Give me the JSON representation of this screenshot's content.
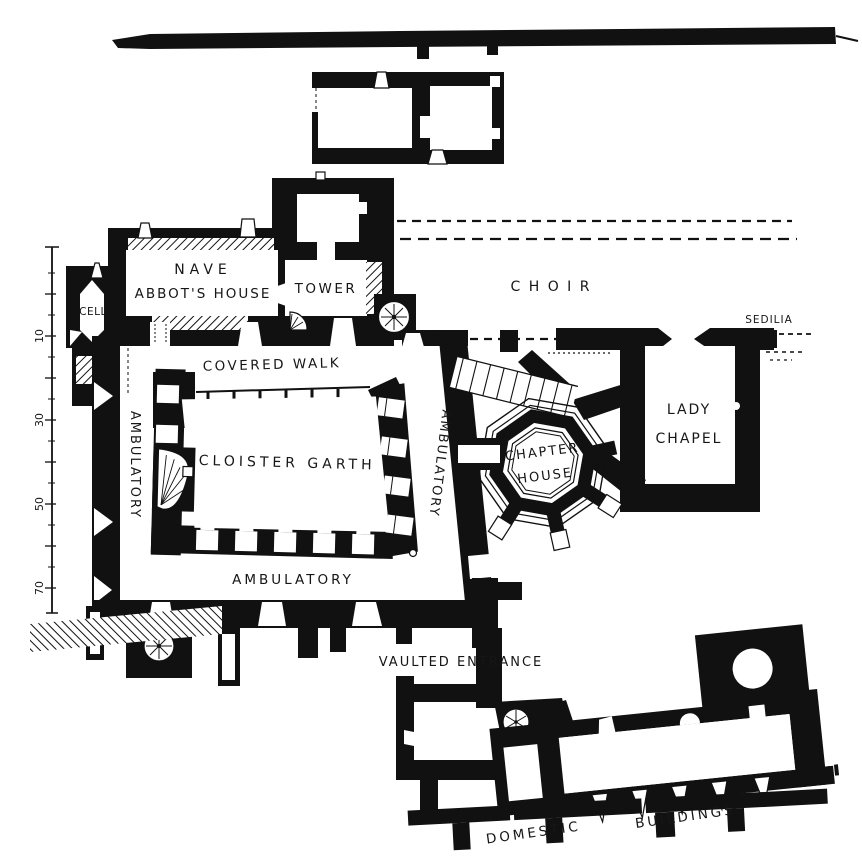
{
  "labels": {
    "nave": "NAVE",
    "abbots_house": "ABBOT'S  HOUSE",
    "cell": "CELL",
    "tower": "TOWER",
    "choir": "C H O I R",
    "sedilia": "SEDILIA",
    "covered_walk": "COVERED  WALK",
    "cloister_garth": "CLOISTER   GARTH",
    "ambulatory_west": "AMBULATORY",
    "ambulatory_east": "AMBULATORY",
    "ambulatory_south": "AMBULATORY",
    "chapter_house_line1": "CHAPTER",
    "chapter_house_line2": "HOUSE",
    "lady_chapel_line1": "LADY",
    "lady_chapel_line2": "CHAPEL",
    "vaulted_entrance": "VAULTED  ENTRANCE",
    "domestic": "DOMESTIC",
    "buildings": "BUILDINGS"
  },
  "scale_bar": {
    "ticks": [
      "10",
      "30",
      "50",
      "70"
    ]
  },
  "colors": {
    "ink": "#111111",
    "paper": "#ffffff"
  }
}
